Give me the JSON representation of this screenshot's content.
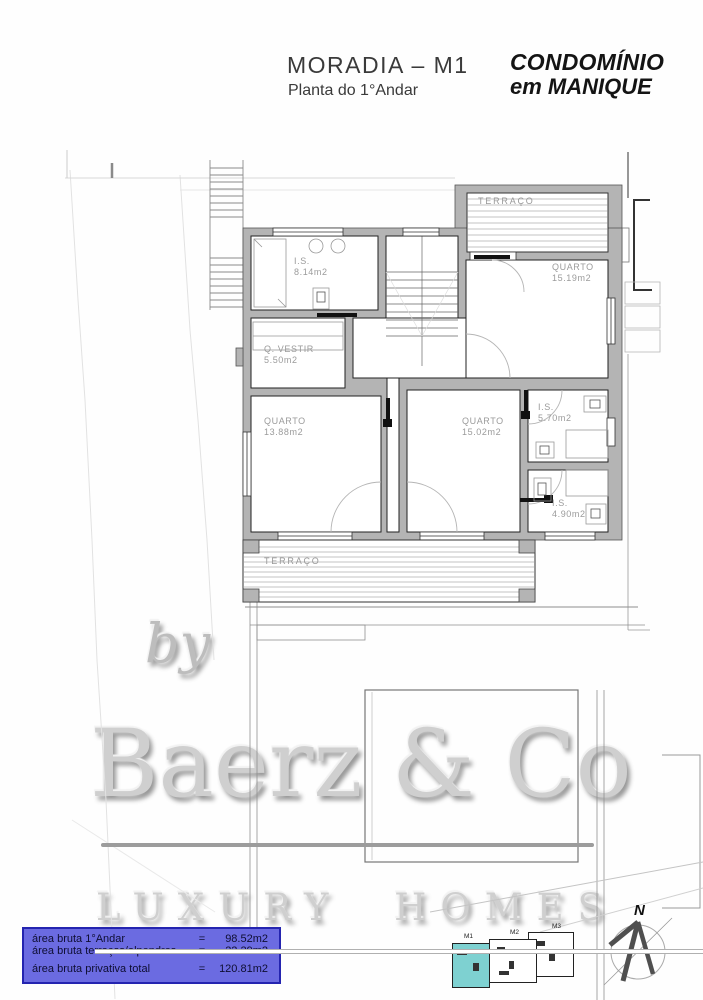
{
  "header": {
    "title": "MORADIA – M1",
    "subtitle": "Planta do 1°Andar"
  },
  "logo": {
    "line1": "CONDOMÍNIO",
    "line2": "em MANIQUE"
  },
  "plan": {
    "rooms": [
      {
        "id": "is-814",
        "name": "I.S.",
        "area": "8.14m2"
      },
      {
        "id": "quarto-1519",
        "name": "QUARTO",
        "area": "15.19m2"
      },
      {
        "id": "q-vestir",
        "name": "Q. VESTIR",
        "area": "5.50m2"
      },
      {
        "id": "quarto-1388",
        "name": "QUARTO",
        "area": "13.88m2"
      },
      {
        "id": "quarto-1502",
        "name": "QUARTO",
        "area": "15.02m2"
      },
      {
        "id": "is-570",
        "name": "I.S.",
        "area": "5.70m2"
      },
      {
        "id": "is-490",
        "name": "I.S.",
        "area": "4.90m2"
      }
    ],
    "terrace_top": "TERRAÇO",
    "terrace_bottom": "TERRAÇO"
  },
  "watermark": {
    "by": "by",
    "name": "Baerz & Co",
    "tagline": "LUXURY HOMES"
  },
  "area_table": {
    "rows": [
      {
        "label": "área bruta 1°Andar",
        "eq": "=",
        "value": "98.52m2"
      },
      {
        "label": "área bruta terraços/alpendres",
        "eq": "=",
        "value": "22.29m2"
      },
      {
        "label": "área bruta privativa total",
        "eq": "=",
        "value": "120.81m2"
      }
    ]
  },
  "minimap": {
    "units": [
      {
        "label": "M1"
      },
      {
        "label": "M2"
      },
      {
        "label": "M3"
      }
    ]
  },
  "compass": {
    "north_label": "N"
  },
  "colors": {
    "table_bg": "#6b6be1",
    "table_border": "#2424b0",
    "table_text": "#0e0e32",
    "m1_highlight": "#7ed1d1",
    "label_gray": "#9b9b9b"
  }
}
